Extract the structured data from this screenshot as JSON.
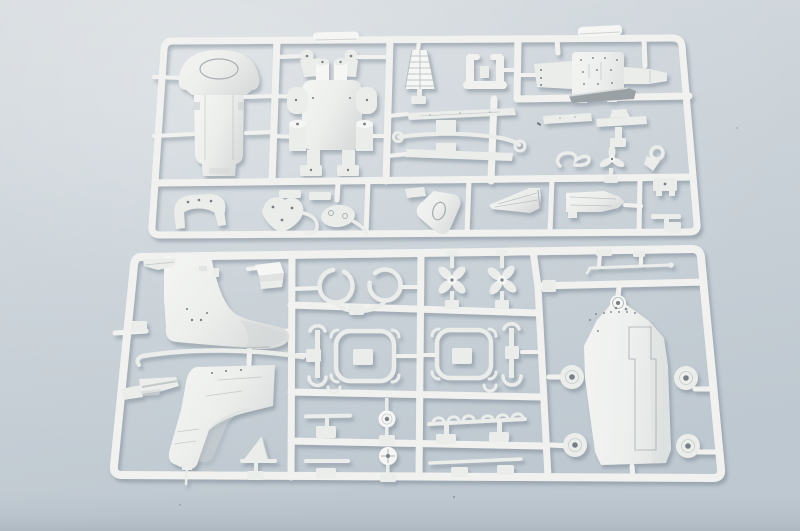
{
  "scene": {
    "description": "Photograph of two white injection-molded plastic model kit sprues (part runners) lying on a pale blue-gray surface, lit from the upper left with soft shadows under the plastic frames",
    "top_sprue": {
      "name": "top-sprue",
      "parts": [
        "gun-shield-plate",
        "gun-carriage-frame",
        "lattice-mast-cone",
        "u-shaped-bracket",
        "equipment-deck-plate",
        "plate-side-arm",
        "leaf-spring-slats",
        "curved-tie-rod",
        "dark-edge-slat",
        "s-hook-fitting",
        "three-blade-rotor",
        "eyelet-fitting",
        "saddle-bracket",
        "heart-shaped-bracket",
        "oval-fitting",
        "spade-shaped-shield",
        "hull-wedge-half-left",
        "hull-wedge-half-right",
        "t-shaped-stand",
        "runner-tab-left",
        "runner-tab-right"
      ]
    },
    "bottom_sprue": {
      "name": "bottom-sprue",
      "parts": [
        "superstructure-half-upper",
        "superstructure-half-lower",
        "curved-handrail-rod",
        "step-bracket",
        "ring-clamp-pair",
        "four-blade-propeller-1",
        "four-blade-propeller-2",
        "thin-mast-rod",
        "deck-pontoon-plate",
        "side-sponson-discs",
        "clamp-frame-1",
        "clamp-frame-2",
        "crescent-strut-1",
        "crescent-strut-2",
        "scalloped-rack",
        "pulley-disc-upper",
        "pulley-disc-lower",
        "short-rod-upper",
        "short-rod-lower",
        "long-rod",
        "rudder-fin",
        "corner-box",
        "corner-bracket"
      ]
    }
  },
  "palette": {
    "background_top": "#d7dce0",
    "background_mid": "#cbd3d9",
    "background_bottom": "#bec8d0",
    "band_bottom": "#a9b5bd",
    "plastic": "#f1f2ef",
    "part_fill": "#ebedeb",
    "part_bright": "#f6f7f5",
    "part_shade": "#d2d6d6",
    "engraving": "#a9b0b3",
    "hole": "#767f85",
    "dark_part": "#9aa1a5",
    "speck": "#6d757c",
    "cast_shadow": "rgba(110,124,138,0.45)"
  }
}
